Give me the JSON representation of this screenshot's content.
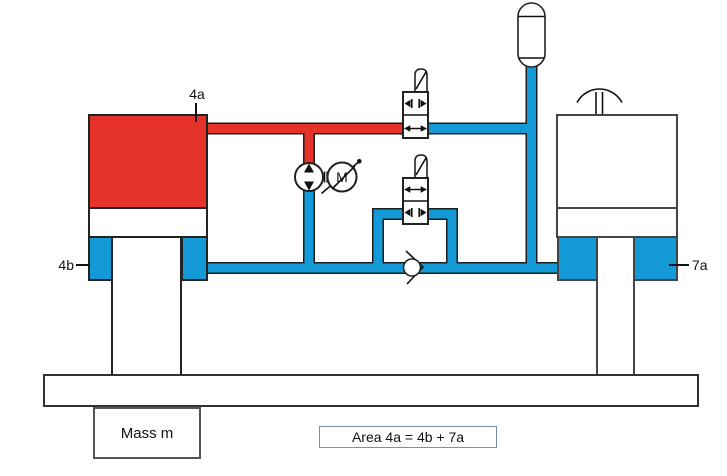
{
  "diagram": {
    "labels": {
      "cap_area": "4a",
      "rod_area_left": "4b",
      "rod_area_right": "7a"
    },
    "mass_box": "Mass m",
    "area_box": "Area 4a = 4b + 7a",
    "motor": "M"
  },
  "icons": {
    "pump": "bidirectional-pump-icon",
    "motor": "electric-motor-icon",
    "check_valve": "check-valve-icon",
    "valve_upper": "shutoff-valve-open-icon",
    "valve_lower": "shutoff-valve-closed-icon",
    "accumulator": "accumulator-icon",
    "handle": "hand-lever-icon"
  },
  "colors": {
    "pressure_red": "#e5322b",
    "hydraulic_blue": "#149bd7",
    "outline_dark": "#222222",
    "area_box_border": "#7a93a4"
  }
}
